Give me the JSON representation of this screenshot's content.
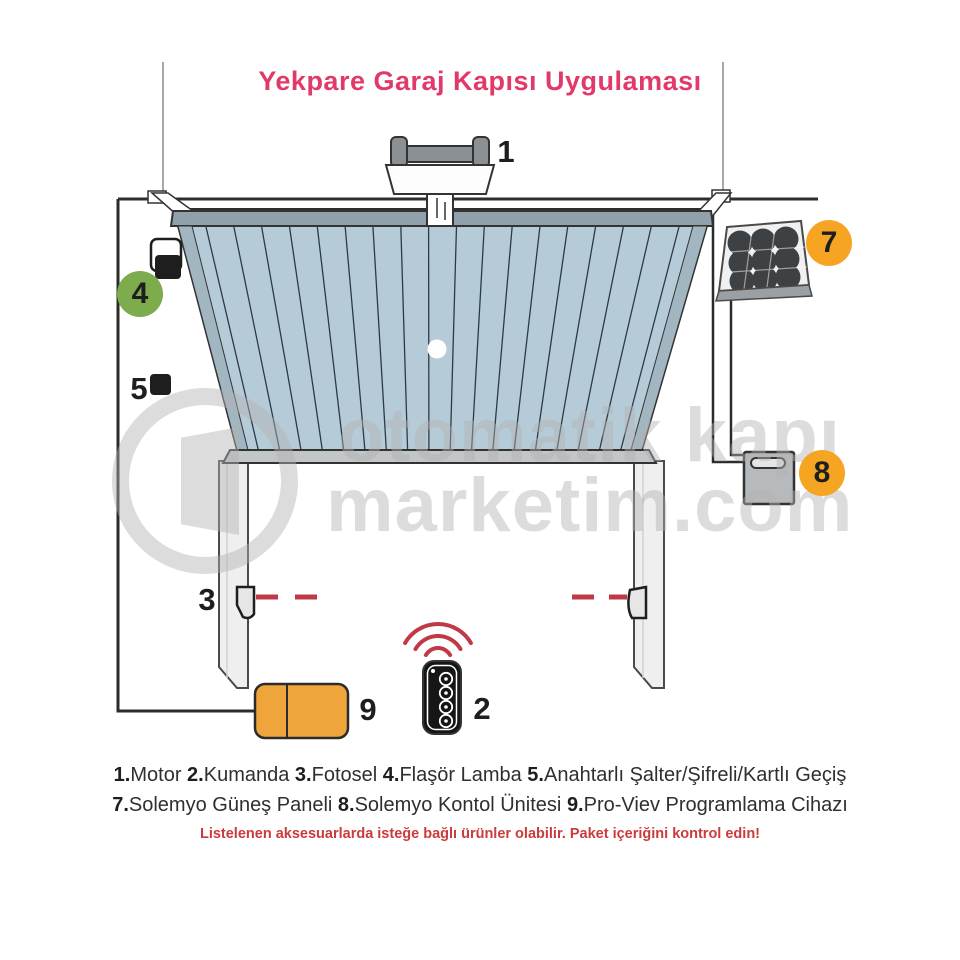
{
  "title": {
    "text": "Yekpare Garaj Kapısı Uygulaması",
    "color": "#e23a68"
  },
  "watermark": {
    "line1": "otomatik kapı",
    "line2": "marketim.com"
  },
  "diagram": {
    "labels": {
      "motor": "1",
      "remote": "2",
      "photocell": "3",
      "flasher": "4",
      "keyswitch": "5",
      "solar": "7",
      "control": "8",
      "proview": "9"
    },
    "colors": {
      "badge_green": "#7cac4b",
      "badge_orange": "#f5a522",
      "door_panel": "#b6cbd8",
      "beam_red": "#bf3a45",
      "device_orange": "#f0a43c"
    }
  },
  "legend": {
    "items": [
      {
        "num": "1.",
        "name": "Motor"
      },
      {
        "num": "2.",
        "name": "Kumanda"
      },
      {
        "num": "3.",
        "name": "Fotosel"
      },
      {
        "num": "4.",
        "name": "Flaşör Lamba"
      },
      {
        "num": "5.",
        "name": "Anahtarlı Şalter/Şifreli/Kartlı Geçiş"
      },
      {
        "num": "7.",
        "name": "Solemyo Güneş Paneli"
      },
      {
        "num": "8.",
        "name": "Solemyo Kontol Ünitesi"
      },
      {
        "num": "9.",
        "name": "Pro-Viev Programlama Cihazı"
      }
    ],
    "note": "Listelenen aksesuarlarda isteğe bağlı ürünler olabilir. Paket içeriğini kontrol edin!"
  }
}
